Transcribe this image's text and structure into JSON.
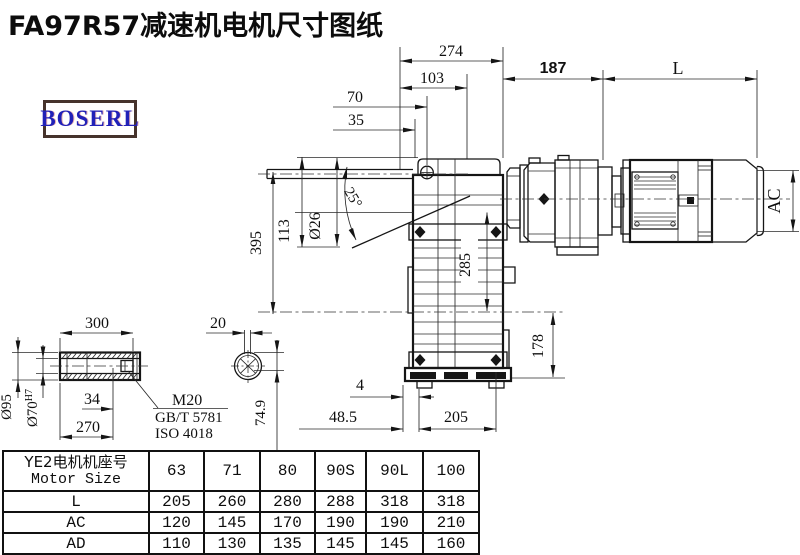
{
  "title": "FA97R57减速机电机尺寸图纸",
  "logo": {
    "text": "BOSERL"
  },
  "drawing": {
    "top_dims": {
      "d274": "274",
      "d103": "103",
      "d70": "70",
      "d35": "35"
    },
    "right_dims": {
      "d187": "187",
      "dL": "L",
      "dAC": "AC"
    },
    "left_dims": {
      "d395": "395",
      "d113": "113",
      "d26": "Ø26",
      "d25": "25°"
    },
    "body_dims": {
      "d285": "285",
      "d178": "178"
    },
    "bottom_dims": {
      "d4": "4",
      "d48_5": "48.5",
      "d205": "205"
    },
    "shaft_detail": {
      "d300": "300",
      "d95": "Ø95",
      "d70_base": "Ø70",
      "d70_sup": "H7",
      "d34": "34",
      "d270": "270",
      "bolt_spec": "M20",
      "bolt_std1": "GB/T 5781",
      "bolt_std2": "ISO 4018"
    },
    "section_detail": {
      "d20": "20",
      "d74_9": "74.9"
    }
  },
  "table": {
    "header_line1": "YE2电机机座号",
    "header_line2": "Motor Size",
    "columns": [
      "63",
      "71",
      "80",
      "90S",
      "90L",
      "100"
    ],
    "rows": [
      {
        "label": "L",
        "values": [
          "205",
          "260",
          "280",
          "288",
          "318",
          "318"
        ]
      },
      {
        "label": "AC",
        "values": [
          "120",
          "145",
          "170",
          "190",
          "190",
          "210"
        ]
      },
      {
        "label": "AD",
        "values": [
          "110",
          "130",
          "135",
          "145",
          "145",
          "160"
        ]
      }
    ]
  }
}
